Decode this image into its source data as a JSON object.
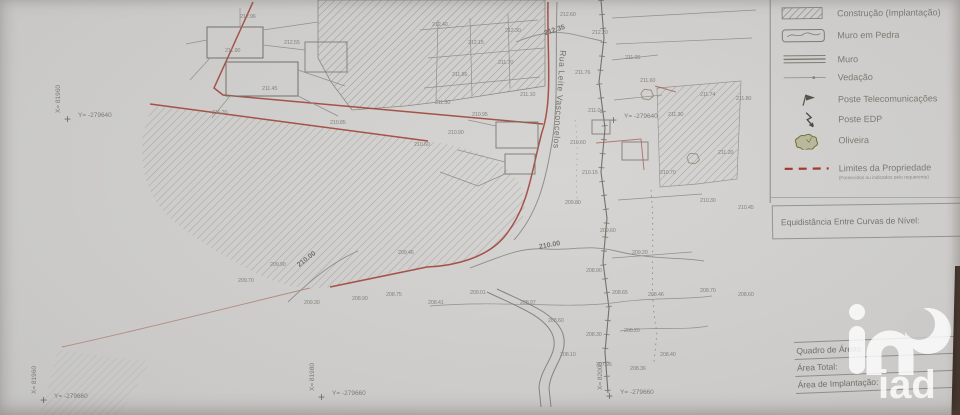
{
  "legend": {
    "items": [
      {
        "id": "construcao",
        "label": "Construção (Implantação)",
        "symbol": "hatched-rect"
      },
      {
        "id": "muro-pedra",
        "label": "Muro em Pedra",
        "symbol": "stone-wall-rect"
      },
      {
        "id": "muro",
        "label": "Muro",
        "symbol": "triple-line"
      },
      {
        "id": "vedacao",
        "label": "Vedação",
        "symbol": "thin-line-dot"
      },
      {
        "id": "poste-telecom",
        "label": "Poste Telecomunicações",
        "symbol": "telecom-pole"
      },
      {
        "id": "poste-edp",
        "label": "Poste EDP",
        "symbol": "edp-pole-zigzag"
      },
      {
        "id": "oliveira",
        "label": "Oliveira",
        "symbol": "olive-tree-scribble"
      },
      {
        "id": "limites",
        "label": "Limites da Propriedade",
        "symbol": "red-dashed-line"
      }
    ],
    "note": "(Fornecidos ou indicados pelo requerente)"
  },
  "equidistancia": {
    "label": "Equidistância Entre Curvas de Nível:"
  },
  "areas_table": {
    "title": "Quadro de Áreas:",
    "rows": [
      {
        "label": "Área Total:",
        "value": "4"
      },
      {
        "label": "Área de Implantação:",
        "value": "2"
      }
    ]
  },
  "map": {
    "street_name": "Rua Leite Vasconcelos",
    "contour_labels": [
      {
        "text": "212.35",
        "x": 544,
        "y": 27,
        "rot": -18
      },
      {
        "text": "210.00",
        "x": 539,
        "y": 242,
        "rot": -10
      },
      {
        "text": "210.00",
        "x": 296,
        "y": 256,
        "rot": -38
      }
    ],
    "grid_crosses": [
      {
        "x": 68,
        "y": 120,
        "x_label": "X= 81960",
        "y_label": "Y= -279640"
      },
      {
        "x": 44,
        "y": 401,
        "x_label": "X= 81960",
        "y_label": "Y= -279660"
      },
      {
        "x": 322,
        "y": 398,
        "x_label": "X= 81980",
        "y_label": "Y= -279660"
      },
      {
        "x": 614,
        "y": 121,
        "x_label": "",
        "y_label": "Y= -279640"
      },
      {
        "x": 610,
        "y": 397,
        "x_label": "X= 82000",
        "y_label": "Y= -279660"
      }
    ],
    "spot_elevations": [
      [
        240,
        14,
        "212.96"
      ],
      [
        284,
        40,
        "212.55"
      ],
      [
        225,
        48,
        "211.90"
      ],
      [
        262,
        86,
        "211.45"
      ],
      [
        212,
        110,
        "211.20"
      ],
      [
        330,
        120,
        "210.85"
      ],
      [
        432,
        22,
        "212.40"
      ],
      [
        468,
        40,
        "212.15"
      ],
      [
        505,
        28,
        "212.30"
      ],
      [
        452,
        72,
        "211.85"
      ],
      [
        498,
        60,
        "211.70"
      ],
      [
        435,
        100,
        "211.30"
      ],
      [
        520,
        92,
        "211.10"
      ],
      [
        472,
        112,
        "210.95"
      ],
      [
        560,
        12,
        "212.60"
      ],
      [
        592,
        30,
        "212.20"
      ],
      [
        575,
        70,
        "211.76"
      ],
      [
        588,
        108,
        "211.04"
      ],
      [
        570,
        140,
        "210.60"
      ],
      [
        582,
        170,
        "210.15"
      ],
      [
        565,
        200,
        "209.80"
      ],
      [
        625,
        55,
        "211.95"
      ],
      [
        640,
        78,
        "211.60"
      ],
      [
        668,
        112,
        "211.30"
      ],
      [
        700,
        92,
        "211.74"
      ],
      [
        736,
        96,
        "211.80"
      ],
      [
        718,
        150,
        "211.20"
      ],
      [
        660,
        170,
        "210.70"
      ],
      [
        700,
        198,
        "210.30"
      ],
      [
        738,
        205,
        "210.45"
      ],
      [
        600,
        228,
        "209.60"
      ],
      [
        632,
        250,
        "209.20"
      ],
      [
        586,
        268,
        "208.90"
      ],
      [
        612,
        290,
        "208.65"
      ],
      [
        648,
        292,
        "208.46"
      ],
      [
        700,
        288,
        "208.70"
      ],
      [
        738,
        292,
        "208.60"
      ],
      [
        520,
        300,
        "208.97"
      ],
      [
        548,
        318,
        "208.60"
      ],
      [
        586,
        332,
        "208.30"
      ],
      [
        624,
        328,
        "208.20"
      ],
      [
        560,
        352,
        "208.10"
      ],
      [
        596,
        362,
        "207.95"
      ],
      [
        630,
        366,
        "208.36"
      ],
      [
        660,
        352,
        "208.40"
      ],
      [
        470,
        290,
        "209.01"
      ],
      [
        428,
        300,
        "208.41"
      ],
      [
        386,
        292,
        "208.75"
      ],
      [
        352,
        296,
        "208.90"
      ],
      [
        304,
        300,
        "209.30"
      ],
      [
        398,
        250,
        "209.46"
      ],
      [
        270,
        262,
        "209.90"
      ],
      [
        238,
        278,
        "209.70"
      ],
      [
        448,
        130,
        "210.90"
      ],
      [
        414,
        142,
        "210.60"
      ]
    ]
  },
  "watermark": {
    "brand": "iad"
  },
  "colors": {
    "paper": "#cbcac8",
    "line_gray": "#72726b",
    "boundary_red": "#9e3c31",
    "olive_green": "#72722f",
    "photo_edge": "#3e2f26",
    "watermark_white": "#ffffff"
  }
}
